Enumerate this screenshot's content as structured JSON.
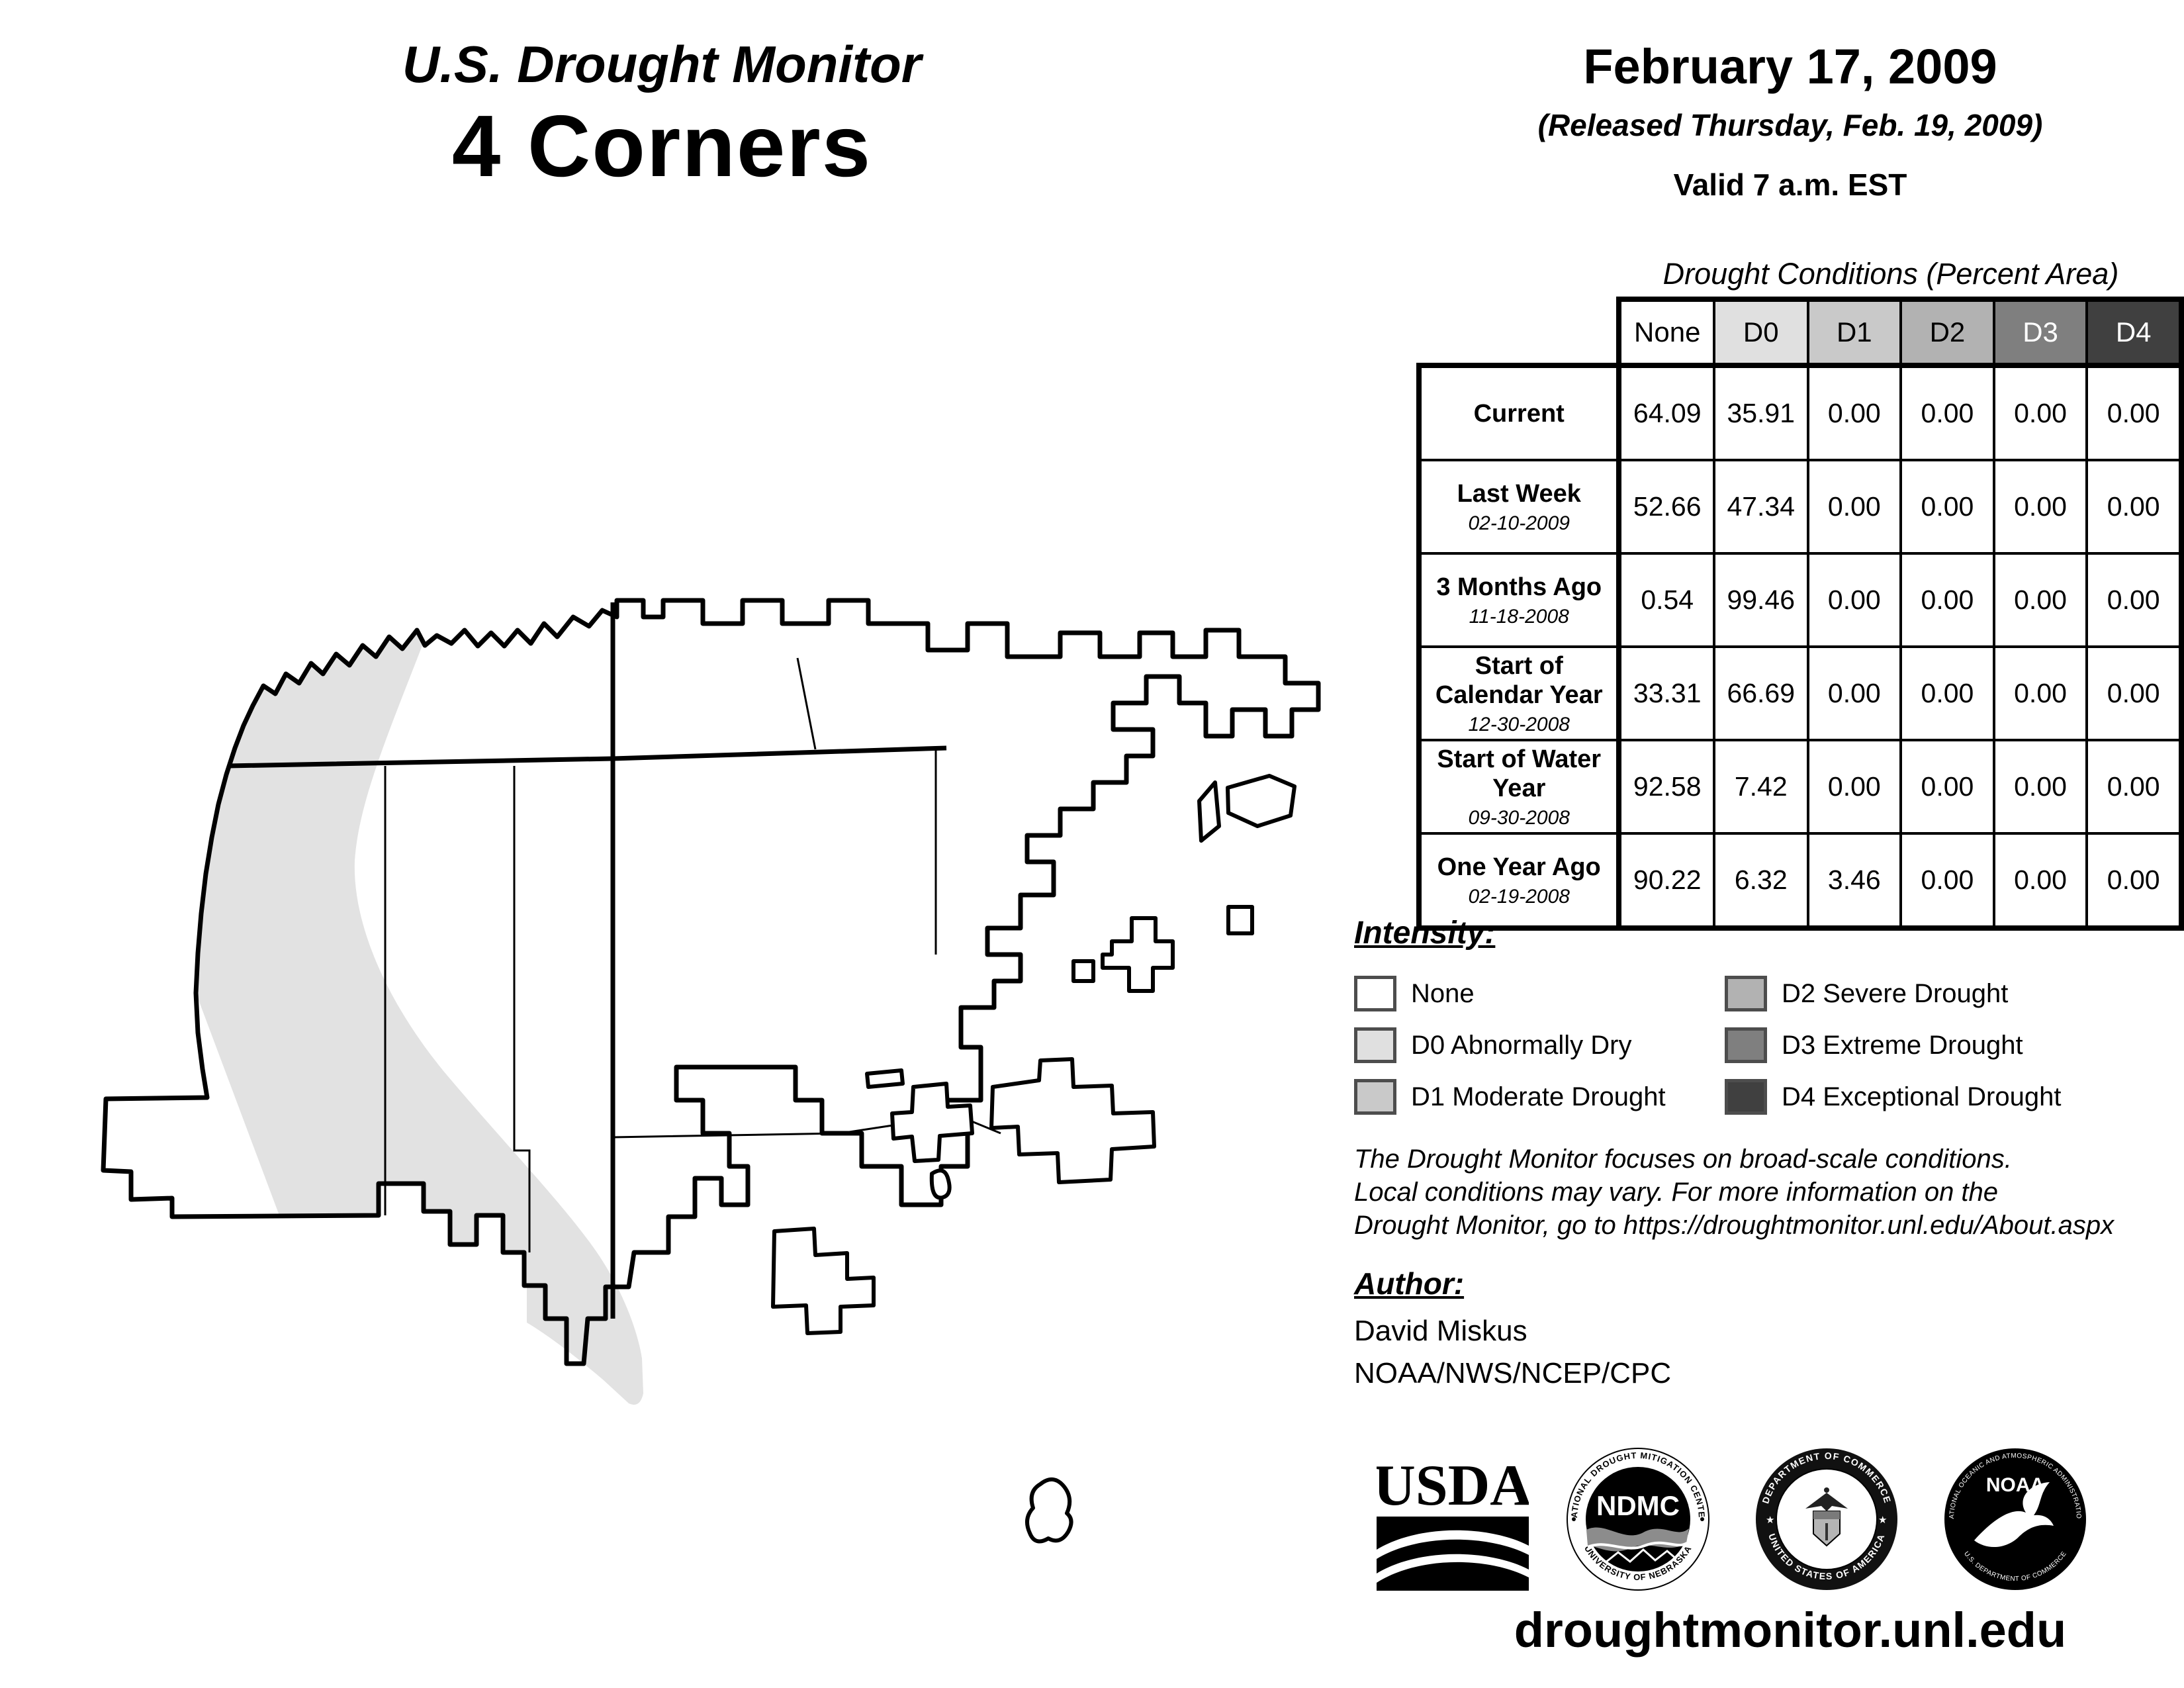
{
  "title": {
    "line1": "U.S. Drought Monitor",
    "line2": "4 Corners"
  },
  "date_block": {
    "date": "February 17, 2009",
    "released": "(Released Thursday, Feb. 19, 2009)",
    "valid": "Valid 7 a.m. EST"
  },
  "table": {
    "caption": "Drought Conditions (Percent Area)",
    "columns": [
      "None",
      "D0",
      "D1",
      "D2",
      "D3",
      "D4"
    ],
    "column_colors": [
      "#ffffff",
      "#e0e0e0",
      "#c9c9c9",
      "#b2b2b2",
      "#7f7f7f",
      "#404040"
    ],
    "column_text_colors": [
      "#000000",
      "#000000",
      "#000000",
      "#000000",
      "#ffffff",
      "#ffffff"
    ],
    "rows": [
      {
        "label": "Current",
        "date": "",
        "values": [
          "64.09",
          "35.91",
          "0.00",
          "0.00",
          "0.00",
          "0.00"
        ]
      },
      {
        "label": "Last Week",
        "date": "02-10-2009",
        "values": [
          "52.66",
          "47.34",
          "0.00",
          "0.00",
          "0.00",
          "0.00"
        ]
      },
      {
        "label": "3 Months Ago",
        "date": "11-18-2008",
        "values": [
          "0.54",
          "99.46",
          "0.00",
          "0.00",
          "0.00",
          "0.00"
        ]
      },
      {
        "label": "Start of Calendar Year",
        "date": "12-30-2008",
        "values": [
          "33.31",
          "66.69",
          "0.00",
          "0.00",
          "0.00",
          "0.00"
        ]
      },
      {
        "label": "Start of Water Year",
        "date": "09-30-2008",
        "values": [
          "92.58",
          "7.42",
          "0.00",
          "0.00",
          "0.00",
          "0.00"
        ]
      },
      {
        "label": "One Year Ago",
        "date": "02-19-2008",
        "values": [
          "90.22",
          "6.32",
          "3.46",
          "0.00",
          "0.00",
          "0.00"
        ]
      }
    ]
  },
  "legend": {
    "heading": "Intensity:",
    "items": [
      {
        "label": "None",
        "color": "#ffffff"
      },
      {
        "label": "D0 Abnormally Dry",
        "color": "#e0e0e0"
      },
      {
        "label": "D1 Moderate Drought",
        "color": "#c9c9c9"
      },
      {
        "label": "D2 Severe Drought",
        "color": "#b2b2b2"
      },
      {
        "label": "D3 Extreme Drought",
        "color": "#7f7f7f"
      },
      {
        "label": "D4 Exceptional Drought",
        "color": "#404040"
      }
    ]
  },
  "disclaimer": {
    "line1": "The Drought Monitor focuses on broad-scale conditions.",
    "line2": "Local conditions may vary. For more information on the",
    "line3": "Drought Monitor, go to https://droughtmonitor.unl.edu/About.aspx"
  },
  "author": {
    "heading": "Author:",
    "name": "David Miskus",
    "org": "NOAA/NWS/NCEP/CPC"
  },
  "footer": {
    "url": "droughtmonitor.unl.edu"
  },
  "logos": {
    "usda": {
      "word": "USDA"
    },
    "ndmc": {
      "center": "NDMC",
      "ring_top": "NATIONAL DROUGHT MITIGATION CENTER",
      "ring_bottom": "UNIVERSITY OF NEBRASKA"
    },
    "doc": {
      "ring_top": "DEPARTMENT OF COMMERCE",
      "ring_bottom": "UNITED STATES OF AMERICA"
    },
    "noaa": {
      "center": "NOAA",
      "ring_top": "NATIONAL OCEANIC AND ATMOSPHERIC ADMINISTRATION",
      "ring_bottom": "U.S. DEPARTMENT OF COMMERCE"
    }
  },
  "map": {
    "region": "4 Corners",
    "shading_present": [
      "None",
      "D0 Abnormally Dry"
    ],
    "d0_color": "#e2e2e2"
  }
}
